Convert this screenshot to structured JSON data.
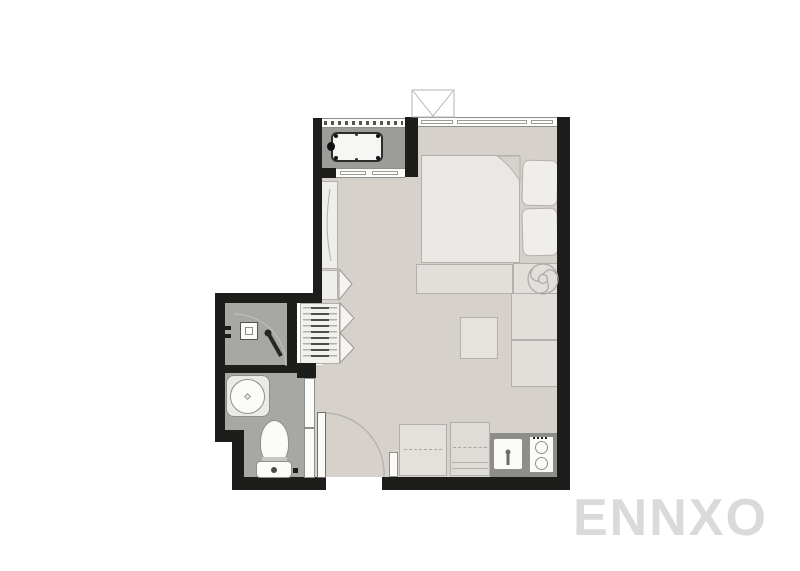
{
  "watermark": {
    "text": "ENNXO",
    "color": "#dadada"
  },
  "palette": {
    "background": "#ffffff",
    "wall": "#1d1d1b",
    "floor_main_room": "#d6d2cb",
    "floor_balcony": "#9c9c9a",
    "floor_bathroom": "#a7a7a5",
    "kitchen_counter_strip": "#8d8d8b",
    "furniture_fill": "#e2dfdb",
    "fixture_white": "#fbfbfa",
    "outline_gray": "#b2b0ac",
    "watermark_gray": "#dadada"
  },
  "plan": {
    "type": "studio-apartment-floor-plan",
    "rooms": [
      {
        "name": "main-room",
        "contents": [
          "bed",
          "pillows",
          "foot-bench",
          "fan",
          "side-console",
          "stool-table",
          "closet",
          "wardrobe"
        ]
      },
      {
        "name": "balcony",
        "contents": [
          "ac-condenser-unit",
          "louver-vent",
          "sliding-door"
        ]
      },
      {
        "name": "bathroom",
        "contents": [
          "shower",
          "wall-sink",
          "washbasin",
          "toilet",
          "sliding-door"
        ]
      },
      {
        "name": "kitchen-zone",
        "contents": [
          "fridge-counter",
          "counter",
          "kitchen-sink",
          "stove-two-burners"
        ]
      }
    ],
    "openings": [
      "top-window",
      "entrance-swing-door",
      "balcony-sliding-door",
      "bathroom-sliding-door"
    ],
    "exterior": [
      "ac-ledge-box"
    ]
  }
}
